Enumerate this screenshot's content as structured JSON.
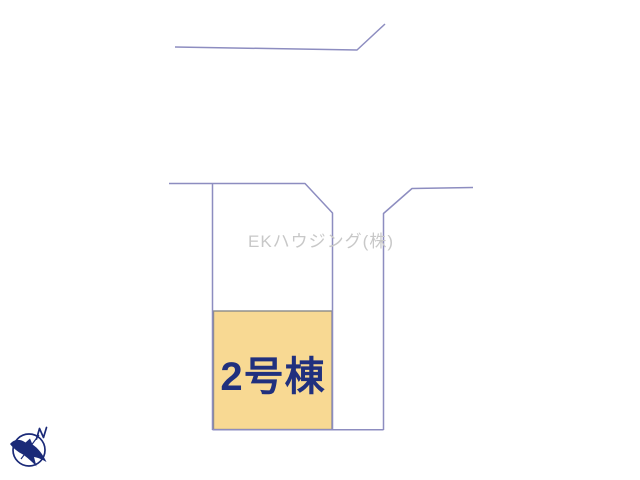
{
  "diagram": {
    "watermark_text": "EKハウジング(株)",
    "building_label": "2号棟",
    "compass_north_label": "N",
    "colors": {
      "background": "#ffffff",
      "boundary_line": "#8d8dc0",
      "building_fill": "#f8d993",
      "building_border": "#8a8a8a",
      "building_label": "#20307e",
      "watermark": "#c8c8c8",
      "compass": "#1b2a78"
    }
  }
}
